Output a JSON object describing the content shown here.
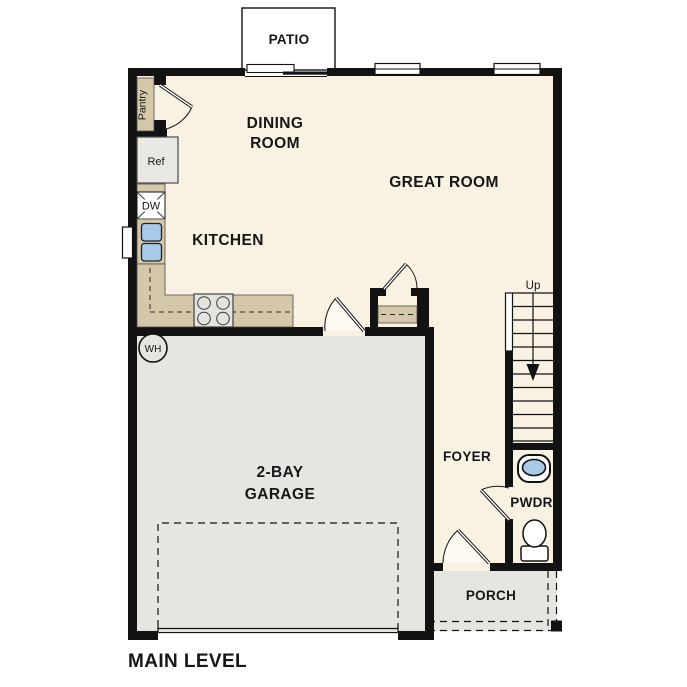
{
  "plan": {
    "title": "MAIN LEVEL",
    "rooms": {
      "patio": "PATIO",
      "dining_line1": "DINING",
      "dining_line2": "ROOM",
      "great_room": "GREAT ROOM",
      "kitchen": "KITCHEN",
      "garage_line1": "2-BAY",
      "garage_line2": "GARAGE",
      "foyer": "FOYER",
      "powder_room": "PWDR",
      "porch": "PORCH"
    },
    "fixtures": {
      "pantry": "Pantry",
      "refrigerator": "Ref",
      "dishwasher": "DW",
      "water_heater": "WH",
      "stairs_direction": "Up"
    }
  },
  "colors": {
    "floor": "#f9f2e3",
    "concrete": "#e6e5e2",
    "casework": "#d5c7a9",
    "wall": "#121212",
    "fixture_water": "#a9c9e9"
  }
}
